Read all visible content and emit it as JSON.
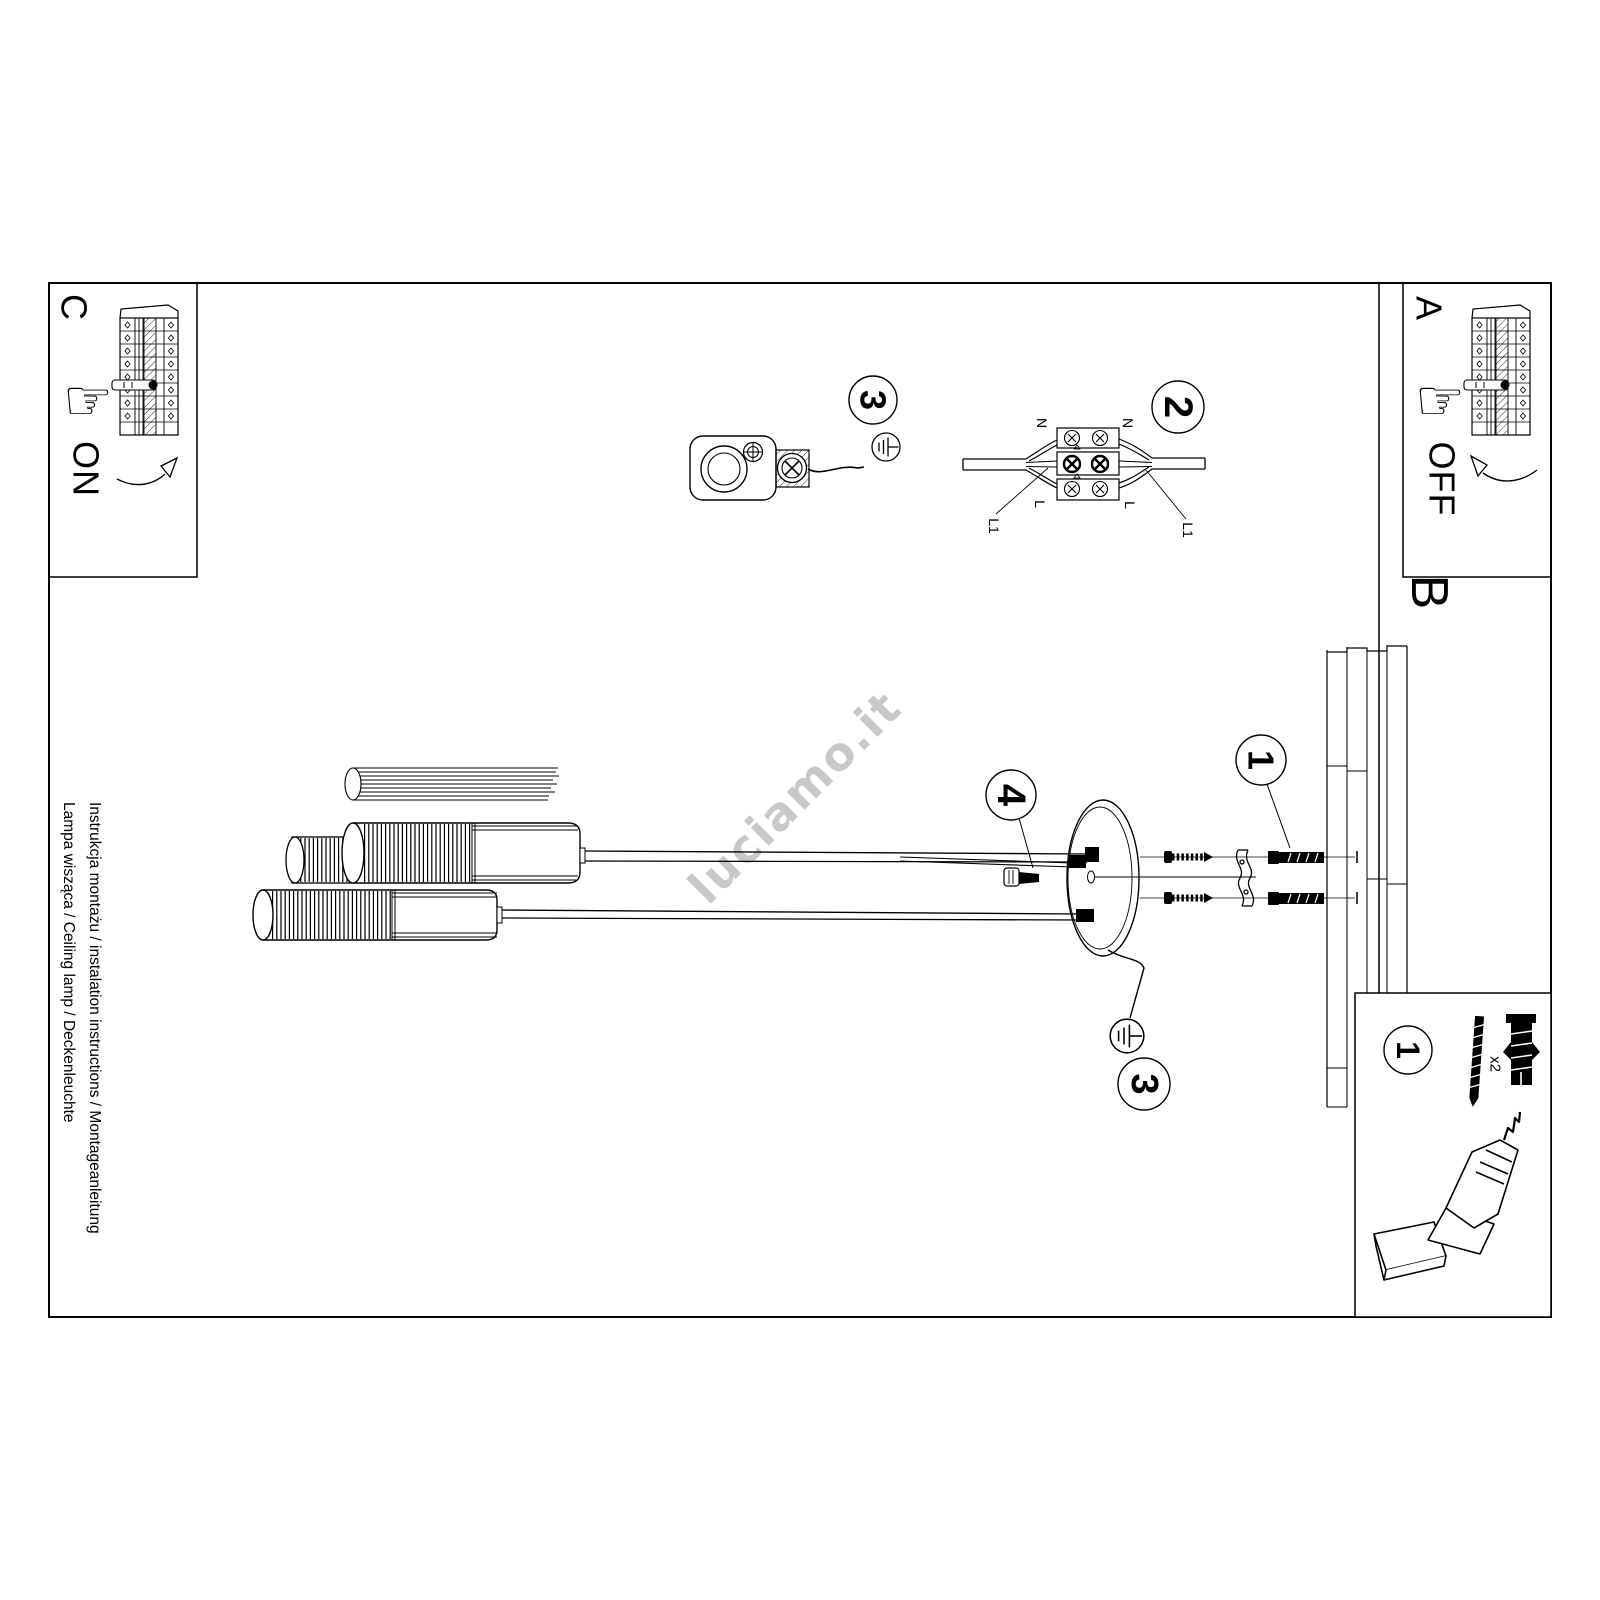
{
  "document": {
    "captions": {
      "line1": "Instrukcja montażu / instalation instructions / Montageanleitung",
      "line2": "Lampa wisząca / Ceiling lamp / Deckenleuchte"
    },
    "watermark": "luciamo.it"
  },
  "sections": {
    "a": {
      "label": "A",
      "switch_state": "OFF"
    },
    "b": {
      "label": "B"
    },
    "c": {
      "label": "C",
      "switch_state": "ON"
    }
  },
  "steps": {
    "wall_plug": "1",
    "parts_kit": "1",
    "wiring": "2",
    "hook": "3",
    "canopy_ground": "3",
    "grub_screw": "4"
  },
  "wiring_labels": {
    "n_left": "N",
    "n_right": "N",
    "l_left": "L",
    "l_right": "L",
    "l1_left": "L1",
    "l1_right": "L1"
  },
  "parts": {
    "screw_qty": "x2"
  },
  "icons": {
    "hand": "☞"
  },
  "colors": {
    "ink": "#000000",
    "paper": "#ffffff",
    "watermark": "#c8c8c8"
  }
}
